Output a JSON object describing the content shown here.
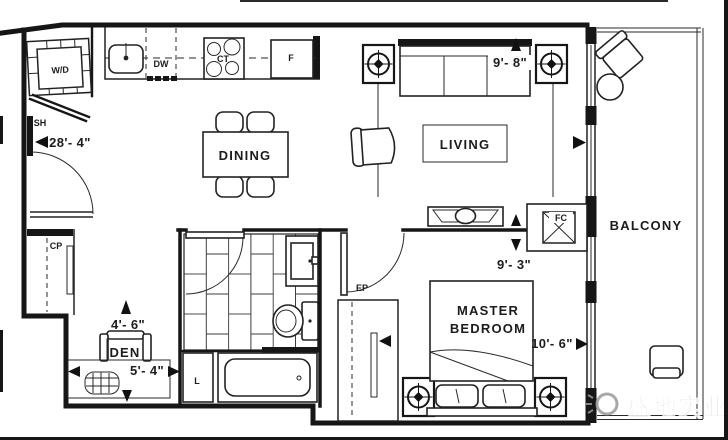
{
  "rooms": {
    "dining": "DINING",
    "living": "LIVING",
    "master_line1": "MASTER",
    "master_line2": "BEDROOM",
    "balcony": "BALCONY",
    "den": "DEN"
  },
  "labels": {
    "washer_dryer": "W/D",
    "dishwasher": "DW",
    "cooktop": "CT",
    "fridge": "F",
    "shelf": "SH",
    "coat_closet": "CP",
    "bedroom_panel": "EP",
    "linen": "L",
    "fan_coil": "FC"
  },
  "dimensions": {
    "overall_length": "28'- 4\"",
    "living_width": "9'- 8\"",
    "living_depth": "9'- 3\"",
    "bedroom_width": "10'- 6\"",
    "den_depth": "4'- 6\"",
    "den_width": "5'- 4\""
  },
  "watermark": {
    "text": "盛地实业"
  }
}
